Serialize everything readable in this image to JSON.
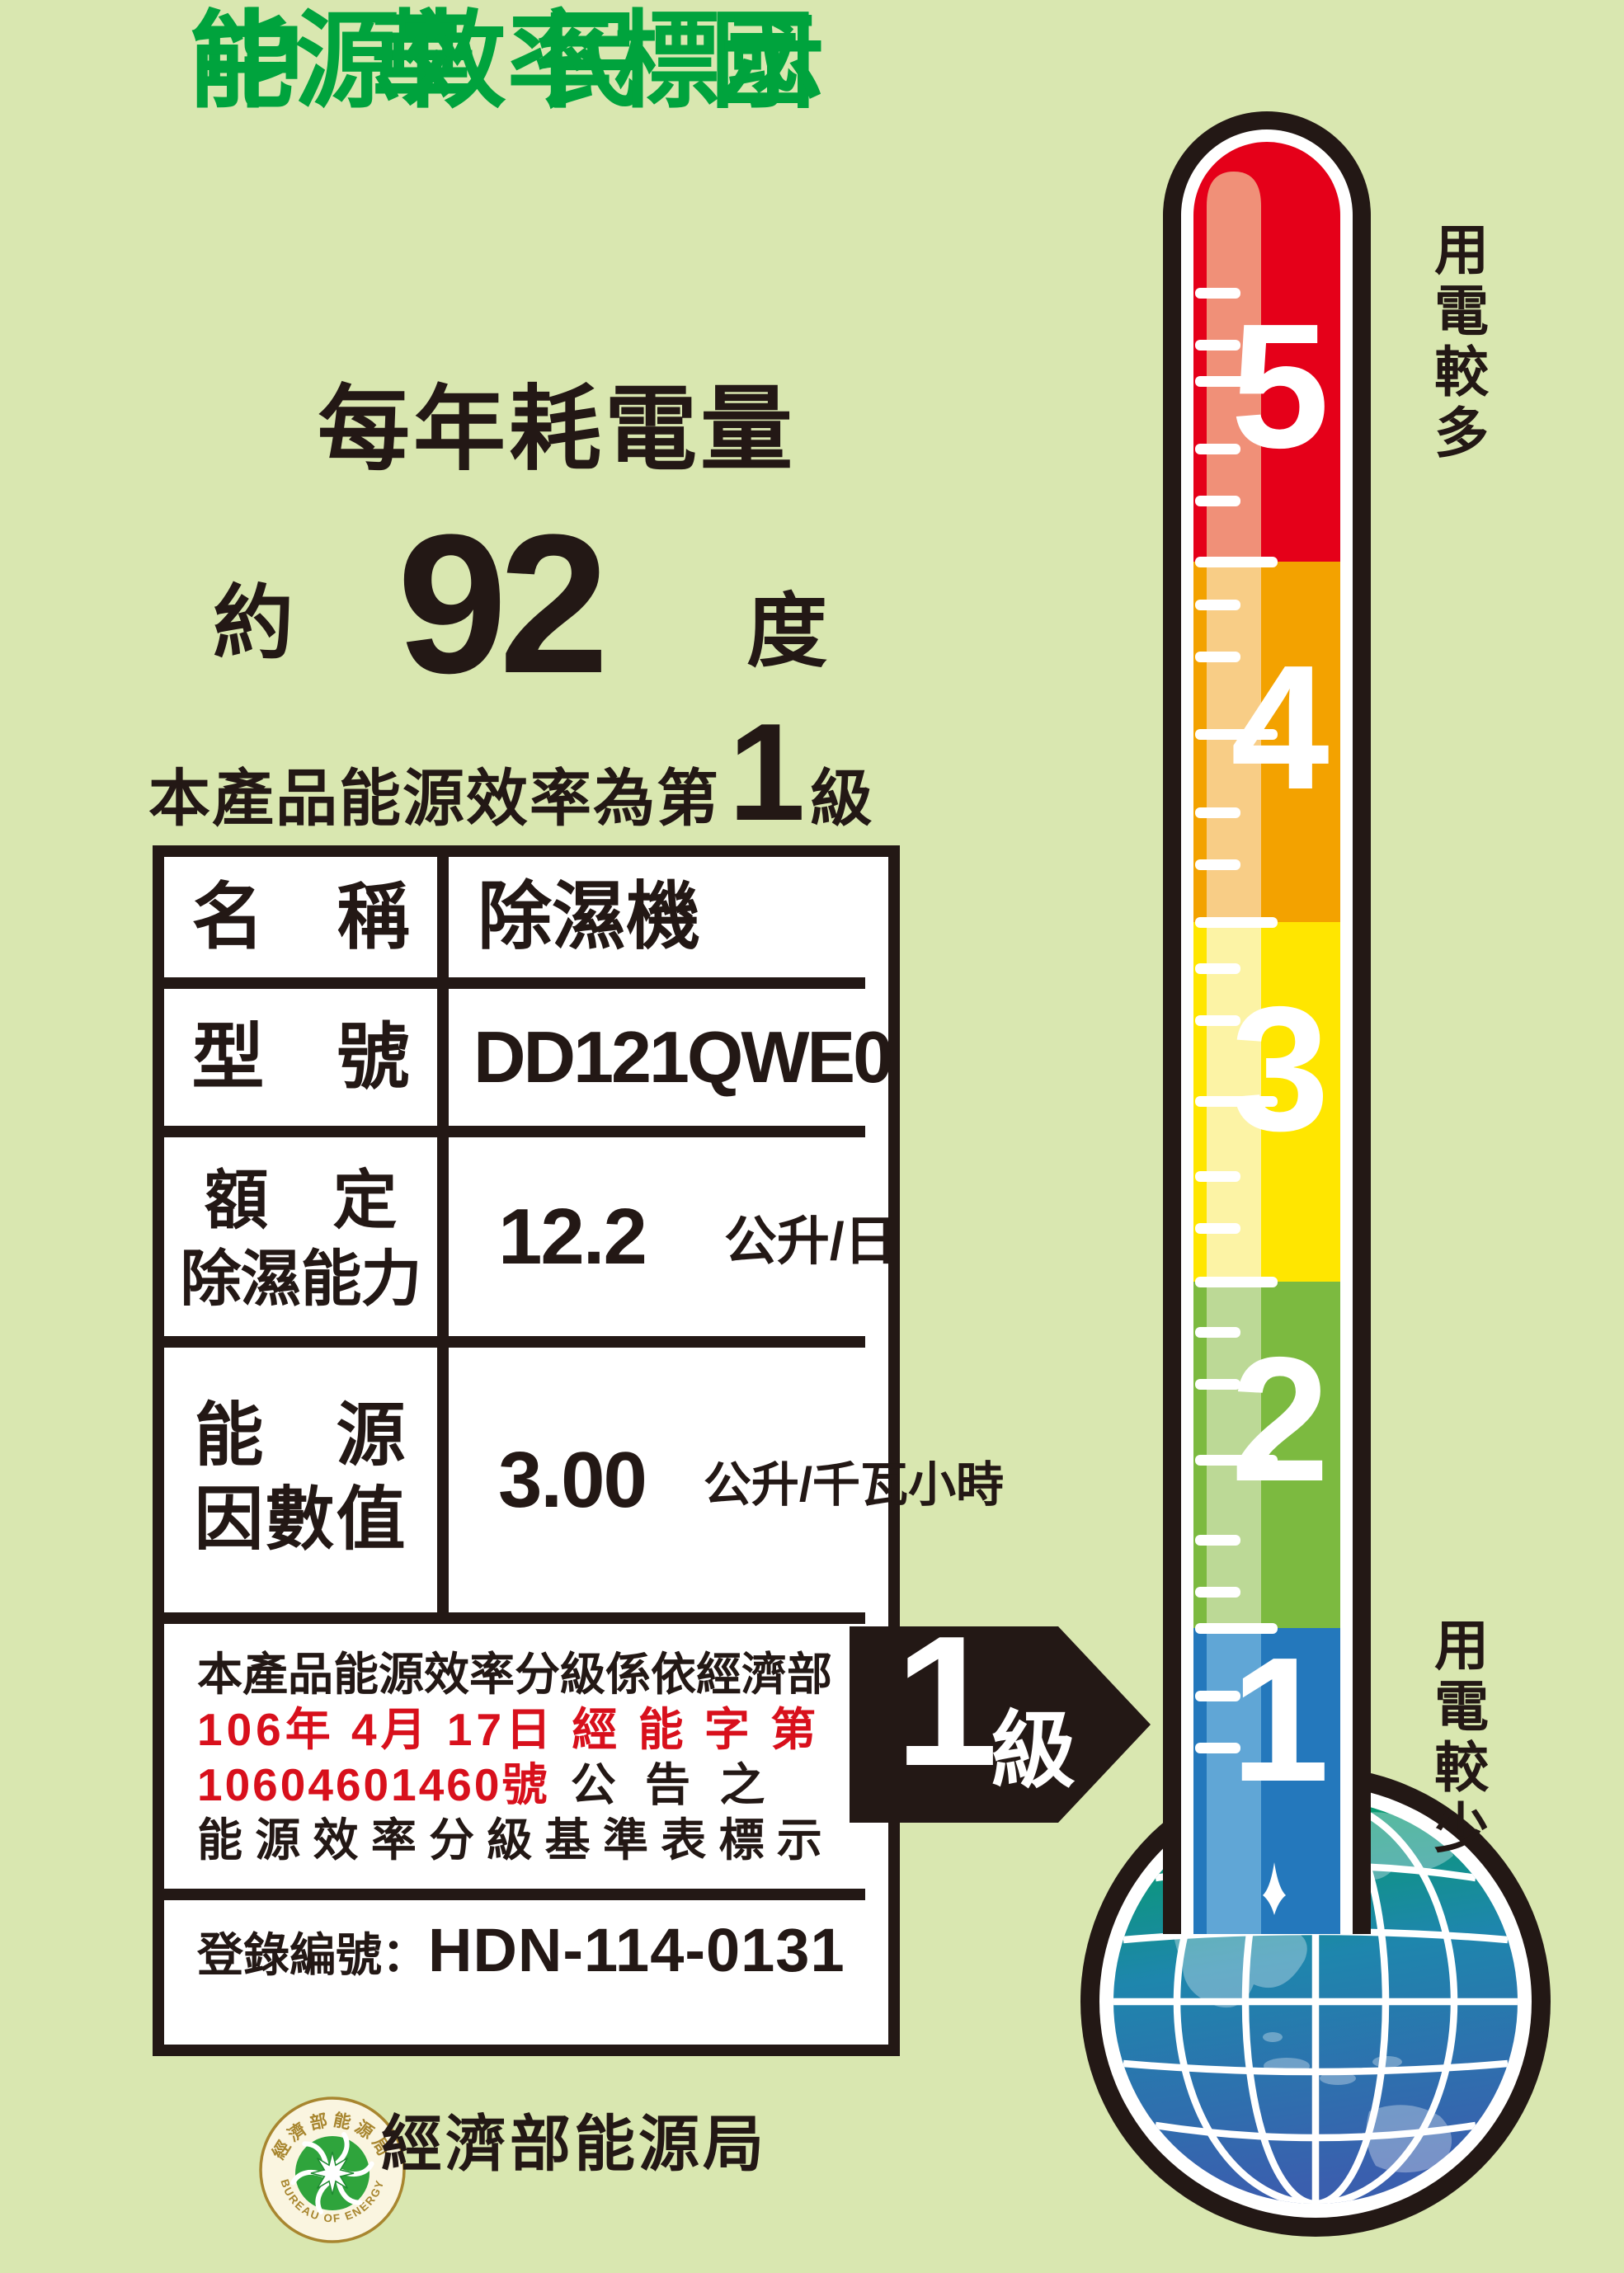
{
  "label": {
    "country_line": "中華民國",
    "title_line": "能源效率標示",
    "subtitle": "每年耗電量"
  },
  "consumption": {
    "prefix": "約",
    "value": "92",
    "unit": "度"
  },
  "grade_sentence": {
    "prefix": "本產品能源效率為第",
    "number": "1",
    "suffix": "級"
  },
  "spec_table": {
    "row_name": {
      "label": "名　稱",
      "value": "除濕機"
    },
    "row_model": {
      "label": "型　號",
      "value": "DD121QWE0"
    },
    "row_capacity": {
      "label_line1": "額　定",
      "label_line2": "除濕能力",
      "value": "12.2",
      "unit": "公升/日"
    },
    "row_energy_factor": {
      "label_line1": "能　源",
      "label_line2": "因數值",
      "value": "3.00",
      "unit": "公升/千瓦小時"
    },
    "notice": {
      "line1": "本產品能源效率分級係依經濟部",
      "line2": "106年 4月 17日 經 能 字 第",
      "line3_red": "10604601460號",
      "line3_black": " 公 告 之",
      "line4": "能 源 效 率 分 級 基 準 表 標 示"
    },
    "registration": {
      "label": "登錄編號：",
      "number": "HDN-114-0131"
    }
  },
  "grade_arrow": {
    "number": "1",
    "suffix": "級"
  },
  "thermometer": {
    "top_label": "用電較多",
    "bottom_label": "用電較少",
    "levels": [
      {
        "value": "5",
        "color": "#e50019",
        "highlight": "#f09078"
      },
      {
        "value": "4",
        "color": "#f3a200",
        "highlight": "#f8cd86"
      },
      {
        "value": "3",
        "color": "#ffe600",
        "highlight": "#fcf3a5"
      },
      {
        "value": "2",
        "color": "#7cba40",
        "highlight": "#bcd996"
      },
      {
        "value": "1",
        "color": "#2478bc",
        "highlight": "#60a6d6"
      }
    ]
  },
  "footer": {
    "seal_arc_top": "經濟部能源局",
    "seal_arc_bottom": "BUREAU OF ENERGY",
    "agency": "經濟部能源局"
  },
  "colors": {
    "background": "#d9e7b0",
    "ink": "#231815",
    "title_green": "#00a33d",
    "notice_red": "#d8101c",
    "seal_gold": "#a8862f",
    "seal_green": "#2fa43c"
  }
}
